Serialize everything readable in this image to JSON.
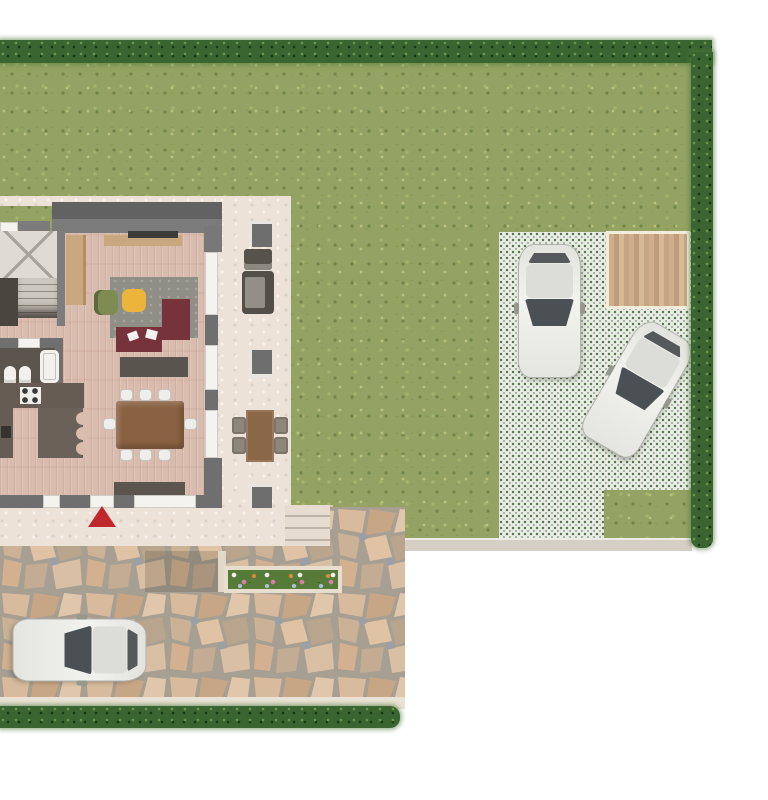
{
  "scene": {
    "kind": "rendered top-view site / ground-floor plan",
    "regions": [
      "garden lawn",
      "perimeter hedge",
      "grass-paver parking area",
      "wooden deck",
      "house ground floor",
      "east patio",
      "south walkway",
      "garden steps",
      "flagstone driveway",
      "flower planter",
      "sidewalk strip"
    ],
    "rooms": [
      "staircase",
      "bathroom",
      "kitchen",
      "living-dining room",
      "study corner"
    ],
    "furniture": [
      "tv cabinet",
      "wardrobe",
      "desk (L-shaped)",
      "office chair",
      "yellow stool",
      "study rug",
      "media cabinet",
      "dining table",
      "dining chairs",
      "kitchen counter with stove",
      "kitchen peninsula with bar stools",
      "bathtub",
      "toilet",
      "bidet",
      "outdoor sofa",
      "outdoor armchair",
      "outdoor dining table",
      "outdoor chairs",
      "window bench"
    ],
    "marker": {
      "shape": "triangle",
      "color_key": "marker_red",
      "location": "at main entrance on south walkway"
    }
  },
  "counts": {
    "cars": 3,
    "dining_chairs": 8,
    "outdoor_chairs": 4,
    "patio_pillars": 3,
    "bar_stool_notches": 3,
    "east_windows": 3,
    "deck_planks": 14
  },
  "cars": [
    {
      "id": "car-parking-vertical",
      "color": "white",
      "heading": "front facing south"
    },
    {
      "id": "car-parking-angled",
      "color": "white",
      "heading": "angled toward southwest"
    },
    {
      "id": "car-driveway",
      "color": "white",
      "heading": "front facing west"
    }
  ],
  "colors": {
    "lawn": "#94a263",
    "hedge": "#3a6531",
    "parking": "#e9ece5",
    "parking_dot": "#54724a",
    "patio": "#ece2d8",
    "wood": "#d9bcae",
    "wall": "#6f6f6f",
    "kitchen": "#665c54",
    "desk": "#76343a",
    "rug": "#8f8f86",
    "chair_olive": "#7e8b52",
    "stool_yellow": "#edb43c",
    "table_brown": "#8a6243",
    "outdoor_table": "#8a6748",
    "glass": "#4b5054",
    "deck_border": "#f3ecda",
    "curb": "#d5cfc5",
    "steps": "#e6dccf",
    "planter_green": "#567a38",
    "marker_red": "#c0272d",
    "sidewalk": "#eae3d5",
    "bath_floor": "#5c554d",
    "cabinet_gray": "#5a544e"
  }
}
